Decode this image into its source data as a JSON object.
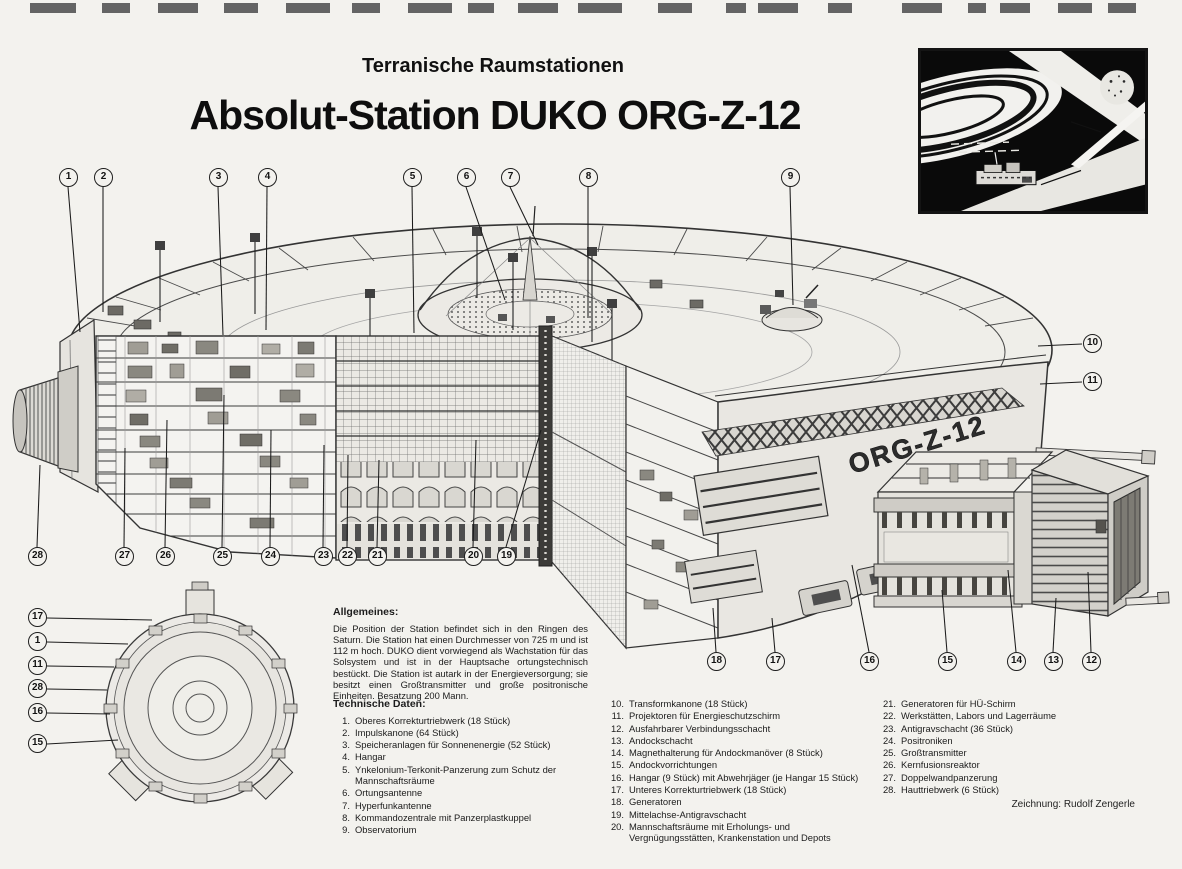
{
  "page": {
    "kicker": "Terranische Raumstationen",
    "title": "Absolut-Station DUKO ORG-Z-12",
    "credit": "Zeichnung: Rudolf Zengerle",
    "hull_label": "ORG-Z-12"
  },
  "colors": {
    "paper": "#f3f2ee",
    "ink": "#1c1c1c",
    "hull_light": "#e9e7e2",
    "shadow_dark": "#3c3b38"
  },
  "allgemeines": {
    "heading": "Allgemeines:",
    "text": "Die Position der Station befindet sich in den Ringen des Saturn. Die Station hat einen Durchmesser von 725 m und ist 112 m hoch. DUKO dient vorwiegend als Wachstation für das Solsystem und ist in der Hauptsache ortungstechnisch bestückt. Die Station ist autark in der Energieversorgung; sie besitzt einen Großtransmitter und große positronische Einheiten. Besatzung 200 Mann."
  },
  "technische_daten": {
    "heading": "Technische Daten:",
    "items": [
      {
        "num": "1.",
        "text": "Oberes Korrekturtriebwerk (18 Stück)"
      },
      {
        "num": "2.",
        "text": "Impulskanone (64 Stück)"
      },
      {
        "num": "3.",
        "text": "Speicheranlagen für Sonnenenergie (52 Stück)"
      },
      {
        "num": "4.",
        "text": "Hangar"
      },
      {
        "num": "5.",
        "text": "Ynkelonium-Terkonit-Panzerung zum Schutz der Mannschaftsräume"
      },
      {
        "num": "6.",
        "text": "Ortungsantenne"
      },
      {
        "num": "7.",
        "text": "Hyperfunkantenne"
      },
      {
        "num": "8.",
        "text": "Kommandozentrale mit Panzerplastkuppel"
      },
      {
        "num": "9.",
        "text": "Observatorium"
      }
    ]
  },
  "legend_col2": [
    {
      "num": "10.",
      "text": "Transformkanone (18 Stück)"
    },
    {
      "num": "11.",
      "text": "Projektoren für Energieschutzschirm"
    },
    {
      "num": "12.",
      "text": "Ausfahrbarer Verbindungsschacht"
    },
    {
      "num": "13.",
      "text": "Andockschacht"
    },
    {
      "num": "14.",
      "text": "Magnethalterung für Andockmanöver (8 Stück)"
    },
    {
      "num": "15.",
      "text": "Andockvorrichtungen"
    },
    {
      "num": "16.",
      "text": "Hangar (9 Stück) mit Abwehrjäger (je Hangar 15 Stück)"
    },
    {
      "num": "17.",
      "text": "Unteres Korrekturtriebwerk (18 Stück)"
    },
    {
      "num": "18.",
      "text": "Generatoren"
    },
    {
      "num": "19.",
      "text": "Mittelachse-Antigravschacht"
    },
    {
      "num": "20.",
      "text": "Mannschaftsräume mit Erholungs- und Vergnügungsstätten, Krankenstation und Depots"
    }
  ],
  "legend_col3": [
    {
      "num": "21.",
      "text": "Generatoren für HÜ-Schirm"
    },
    {
      "num": "22.",
      "text": "Werkstätten, Labors und Lagerräume"
    },
    {
      "num": "23.",
      "text": "Antigravschacht (36 Stück)"
    },
    {
      "num": "24.",
      "text": "Positroniken"
    },
    {
      "num": "25.",
      "text": "Großtransmitter"
    },
    {
      "num": "26.",
      "text": "Kernfusionsreaktor"
    },
    {
      "num": "27.",
      "text": "Doppelwandpanzerung"
    },
    {
      "num": "28.",
      "text": "Hauttriebwerk (6 Stück)"
    }
  ],
  "callouts": {
    "main": [
      "1",
      "2",
      "3",
      "4",
      "5",
      "6",
      "7",
      "8",
      "9",
      "10",
      "11",
      "28",
      "27",
      "26",
      "25",
      "24",
      "23",
      "22",
      "21",
      "20",
      "19",
      "18",
      "17",
      "16",
      "15",
      "14",
      "13",
      "12"
    ],
    "mini": [
      "17",
      "1",
      "11",
      "28",
      "16",
      "15"
    ]
  }
}
